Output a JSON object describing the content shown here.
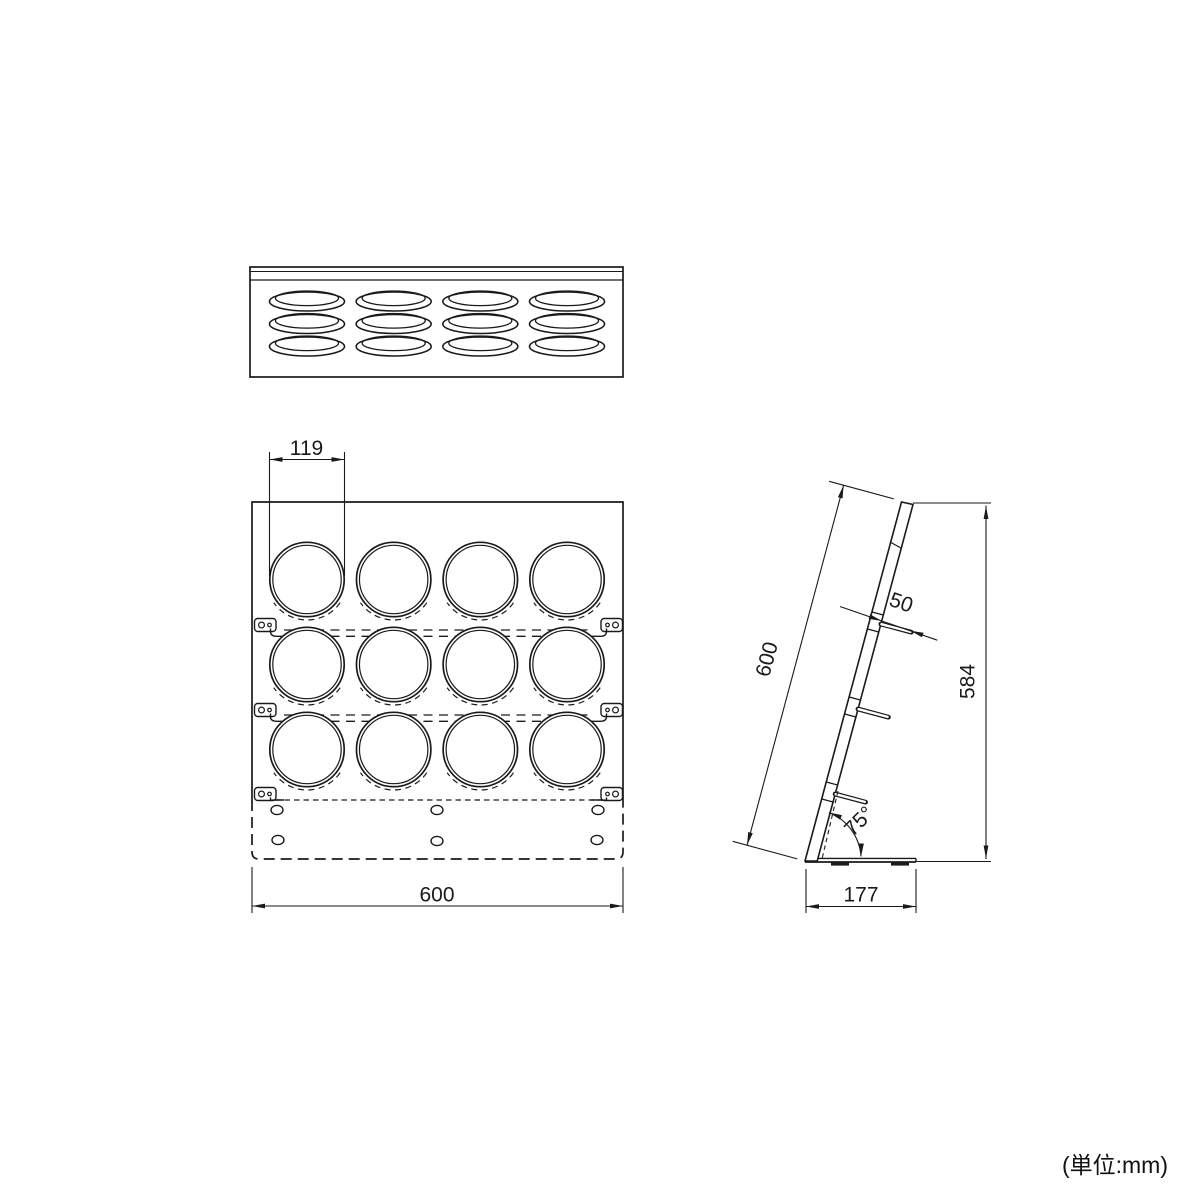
{
  "unit_label": "(単位:mm)",
  "dimensions": {
    "hole_diameter": "119",
    "panel_width": "600",
    "slant_length": "600",
    "overall_height": "584",
    "hook_projection": "50",
    "tilt_angle": "75°",
    "base_depth": "177"
  },
  "structure": {
    "hole_columns": 4,
    "hole_rows": 3,
    "rail_levels": 3,
    "base_holes": 6,
    "side_hooks": 3
  },
  "colors": {
    "line": "#1a1a1a",
    "background": "#ffffff"
  }
}
